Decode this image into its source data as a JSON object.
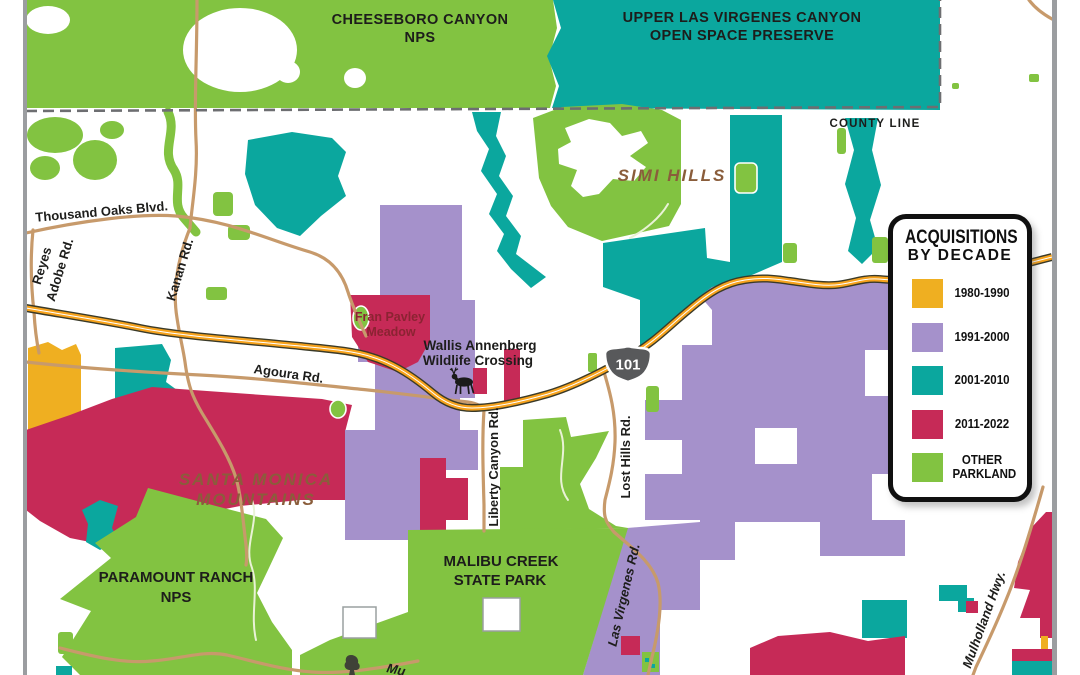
{
  "legend": {
    "title_line1": "ACQUISITIONS",
    "title_line2": "BY DECADE",
    "items": [
      {
        "label": "1980-1990",
        "color": "#EFAF21"
      },
      {
        "label": "1991-2000",
        "color": "#A591CB"
      },
      {
        "label": "2001-2010",
        "color": "#0BA79E"
      },
      {
        "label": "2011-2022",
        "color": "#C62A57"
      },
      {
        "label": "OTHER PARKLAND",
        "label_line1": "OTHER",
        "label_line2": "PARKLAND",
        "color": "#82C341"
      }
    ]
  },
  "map": {
    "county_line_label": "COUNTY LINE",
    "highway_shield": "101",
    "regions": {
      "cheeseboro_line1": "CHEESEBORO CANYON",
      "cheeseboro_line2": "NPS",
      "upper_las_virgenes_line1": "UPPER LAS VIRGENES CANYON",
      "upper_las_virgenes_line2": "OPEN SPACE PRESERVE",
      "simi_hills": "SIMI HILLS",
      "santa_monica_line1": "SANTA MONICA",
      "santa_monica_line2": "MOUNTAINS",
      "paramount_line1": "PARAMOUNT RANCH",
      "paramount_line2": "NPS",
      "malibu_line1": "MALIBU CREEK",
      "malibu_line2": "STATE PARK"
    },
    "pois": {
      "fran_pavley_line1": "Fran Pavley",
      "fran_pavley_line2": "Meadow",
      "wallis_line1": "Wallis Annenberg",
      "wallis_line2": "Wildlife Crossing"
    },
    "roads": {
      "thousand_oaks": "Thousand Oaks Blvd.",
      "reyes_line1": "Reyes",
      "reyes_line2": "Adobe Rd.",
      "kanan": "Kanan Rd.",
      "agoura": "Agoura Rd.",
      "liberty_canyon": "Liberty Canyon Rd.",
      "lost_hills": "Lost Hills Rd.",
      "las_virgenes": "Las Virgenes Rd.",
      "mulholland": "Mulholland Hwy.",
      "mulholland_partial": "Mu"
    }
  },
  "colors": {
    "parkland_green": "#82C341",
    "teal": "#0BA79E",
    "purple": "#A591CB",
    "crimson": "#C62A57",
    "orange": "#EFAF21",
    "road_tan": "#C79A6B",
    "freeway_orange": "#F6A21C",
    "freeway_edge": "#3A3A28",
    "county_gray": "#6D6E71",
    "border_gray": "#9B9DA0",
    "brown_label": "#8A5D3B",
    "maroon_label": "#8B2332",
    "label_black": "#1D1D1B",
    "shield_gray": "#58595B"
  }
}
